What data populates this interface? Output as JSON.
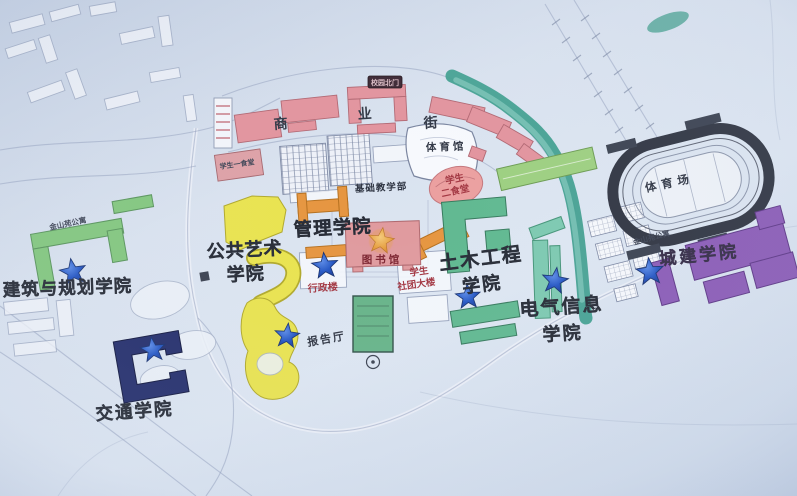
{
  "colleges": [
    {
      "id": "architecture",
      "label": "建筑与规划学院",
      "color": "#82c77e"
    },
    {
      "id": "transportation",
      "label": "交通学院",
      "color": "#232d6b"
    },
    {
      "id": "public-art",
      "label_line1": "公共艺术",
      "label_line2": "学院",
      "color": "#e9e34e"
    },
    {
      "id": "management",
      "label": "管理学院",
      "color": "#e6953f"
    },
    {
      "id": "civil-engineering",
      "label_line1": "土木工程",
      "label_line2": "学院",
      "color": "#5fb890"
    },
    {
      "id": "electrical-information",
      "label_line1": "电气信息",
      "label_line2": "学院",
      "color": "#7cc9b0"
    },
    {
      "id": "urban-construction",
      "label": "城建学院",
      "color": "#8a5ab6"
    }
  ],
  "facilities": {
    "library": "图书馆",
    "admin_building": "行政楼",
    "student_union_line1": "学生",
    "student_union_line2": "社团大楼",
    "lecture_hall": "报告厅",
    "gymnasium": "体育馆",
    "basic_teaching": "基础教学部",
    "stadium": "体育场",
    "canteen2_line1": "学生",
    "canteen2_line2": "二食堂",
    "canteen1": "学生一食堂",
    "street_char1": "商",
    "street_char2": "业",
    "street_char3": "街",
    "north_gate": "校园北门",
    "apartment_left": "金山苑公寓",
    "apartment_right": "金山苑公寓"
  },
  "markers": {
    "blue_star_color": "#2456c4",
    "library_star_color": "#e8a13c",
    "blue_star_count": 7
  },
  "map_features": {
    "river_color": "#3f9e8e",
    "track_color": "#2e3340",
    "paper_color": "#d9e2ef"
  }
}
